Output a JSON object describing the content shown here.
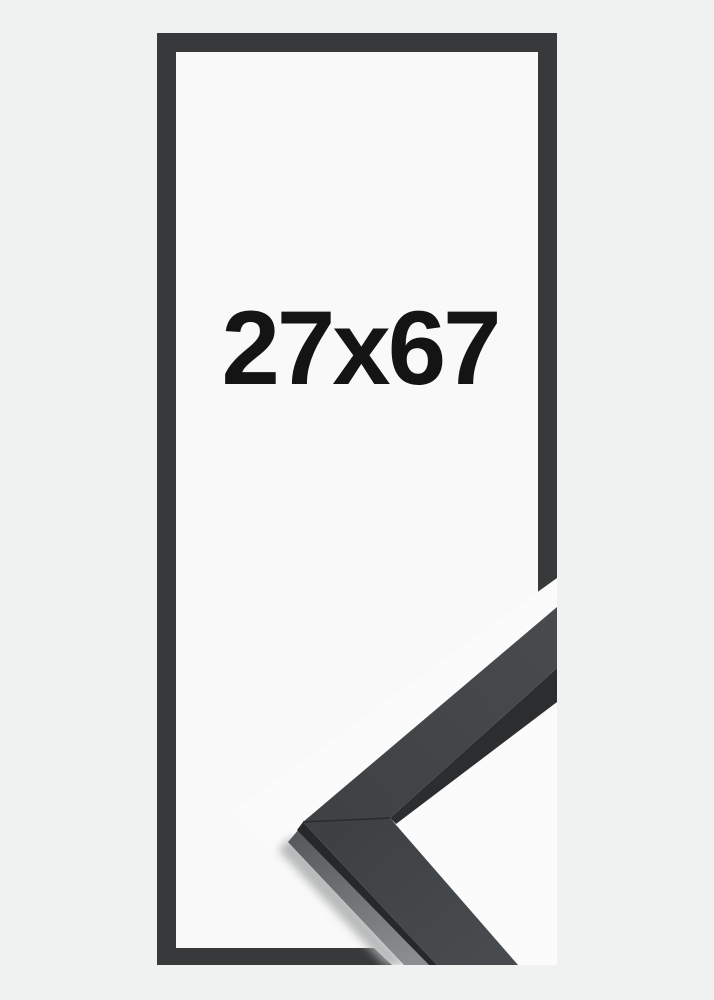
{
  "product": {
    "size_label": "27x67"
  },
  "colors": {
    "background": "#f0f1f1",
    "opening": "#f9f9f9",
    "overlay": "#fbfbfb",
    "outline": "#37393b",
    "face": "#3e4143",
    "face_light": "#484b4d",
    "edge_dark": "#26282a",
    "strip_dark": "#2b2d2f",
    "bevel": "#55595b",
    "bevel_light": "#8a8e90",
    "shadow": "#abaeae",
    "text": "#141414"
  }
}
